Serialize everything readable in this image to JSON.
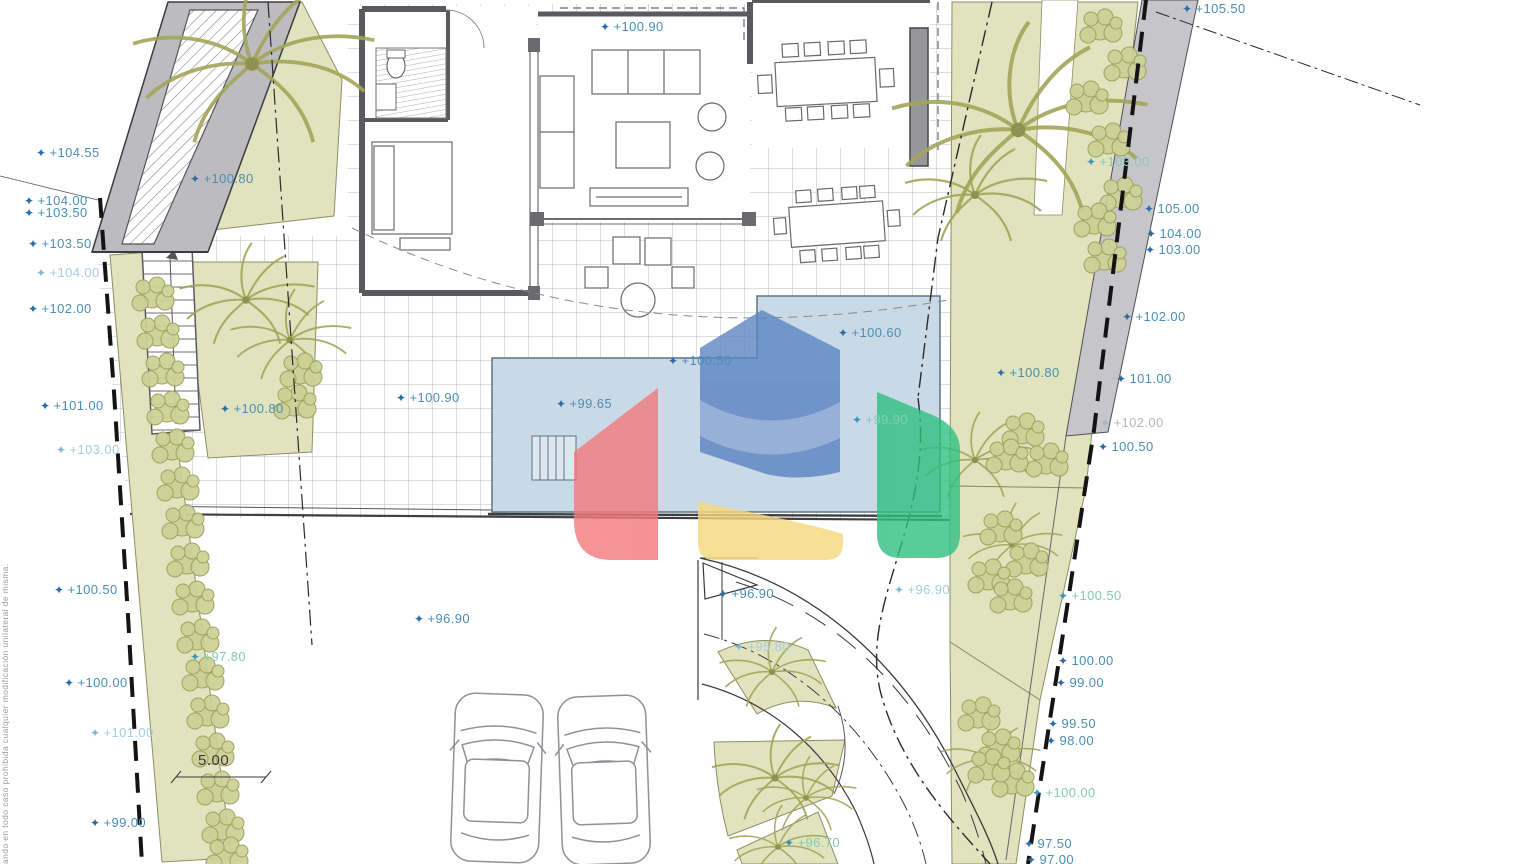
{
  "title": "Villa site plan with pool, garden and driveway",
  "dimension": {
    "value": "5.00"
  },
  "side_note": "ando en todo caso prohibida cualquier modificación unilateral de misma.",
  "colors": {
    "label_teal": "#4a8fb5",
    "label_faint": "#a5cde0",
    "label_green": "#85ccb2",
    "label_gray": "#b8b8ba",
    "marker_blue": "#2d6da6",
    "garden_green": "#e0e3bd",
    "plant_olive": "#a3a558",
    "pool_blue": "#c9d9e6",
    "wall_gray": "#bcbcc0",
    "logo_red": "#f2797d",
    "logo_blue": "#5b84c2",
    "logo_lightblue": "#8fabd6",
    "logo_yellow": "#f6d97c",
    "logo_green": "#2fbf81"
  },
  "labels": [
    {
      "t": "+104.55",
      "x": 36,
      "y": 146,
      "c": "lt"
    },
    {
      "t": "+104.00",
      "x": 24,
      "y": 194,
      "c": "lt"
    },
    {
      "t": "+103.50",
      "x": 24,
      "y": 206,
      "c": "lt"
    },
    {
      "t": "+103.50",
      "x": 28,
      "y": 237,
      "c": "lt"
    },
    {
      "t": "+104.00",
      "x": 36,
      "y": 266,
      "c": "lf"
    },
    {
      "t": "+102.00",
      "x": 28,
      "y": 302,
      "c": "lt"
    },
    {
      "t": "+101.00",
      "x": 40,
      "y": 399,
      "c": "lt"
    },
    {
      "t": "+103.00",
      "x": 56,
      "y": 443,
      "c": "lf"
    },
    {
      "t": "+100.50",
      "x": 54,
      "y": 583,
      "c": "lt"
    },
    {
      "t": "+97.80",
      "x": 190,
      "y": 650,
      "c": "lg"
    },
    {
      "t": "+100.00",
      "x": 64,
      "y": 676,
      "c": "lt"
    },
    {
      "t": "+101.00",
      "x": 90,
      "y": 726,
      "c": "lf"
    },
    {
      "t": "+99.00",
      "x": 90,
      "y": 816,
      "c": "lt"
    },
    {
      "t": "+100.90",
      "x": 600,
      "y": 20,
      "c": "lt"
    },
    {
      "t": "+100.80",
      "x": 190,
      "y": 172,
      "c": "lt"
    },
    {
      "t": "+100.80",
      "x": 220,
      "y": 402,
      "c": "lt"
    },
    {
      "t": "+100.90",
      "x": 396,
      "y": 391,
      "c": "lt"
    },
    {
      "t": "+99.65",
      "x": 556,
      "y": 397,
      "c": "lt"
    },
    {
      "t": "+100.50",
      "x": 668,
      "y": 354,
      "c": "lt"
    },
    {
      "t": "+100.60",
      "x": 838,
      "y": 326,
      "c": "lt"
    },
    {
      "t": "+99.90",
      "x": 852,
      "y": 413,
      "c": "lg"
    },
    {
      "t": "+96.90",
      "x": 414,
      "y": 612,
      "c": "lt"
    },
    {
      "t": "+96.90",
      "x": 718,
      "y": 587,
      "c": "lt"
    },
    {
      "t": "+96.90",
      "x": 894,
      "y": 583,
      "c": "lf"
    },
    {
      "t": "+95.80",
      "x": 734,
      "y": 640,
      "c": "lf"
    },
    {
      "t": "+96.70",
      "x": 784,
      "y": 836,
      "c": "lg"
    },
    {
      "t": "+105.50",
      "x": 1182,
      "y": 2,
      "c": "lt"
    },
    {
      "t": "+103.00",
      "x": 1086,
      "y": 155,
      "c": "lg"
    },
    {
      "t": "105.00",
      "x": 1144,
      "y": 202,
      "c": "lt"
    },
    {
      "t": "104.00",
      "x": 1146,
      "y": 227,
      "c": "lt"
    },
    {
      "t": "103.00",
      "x": 1145,
      "y": 243,
      "c": "lt"
    },
    {
      "t": "+102.00",
      "x": 1122,
      "y": 310,
      "c": "lt"
    },
    {
      "t": "+100.80",
      "x": 996,
      "y": 366,
      "c": "lt"
    },
    {
      "t": "101.00",
      "x": 1116,
      "y": 372,
      "c": "lt"
    },
    {
      "t": "+102.00",
      "x": 1100,
      "y": 416,
      "c": "ly"
    },
    {
      "t": "100.50",
      "x": 1098,
      "y": 440,
      "c": "lt"
    },
    {
      "t": "+100.50",
      "x": 1058,
      "y": 589,
      "c": "lg"
    },
    {
      "t": "100.00",
      "x": 1058,
      "y": 654,
      "c": "lt"
    },
    {
      "t": "99.00",
      "x": 1056,
      "y": 676,
      "c": "lt"
    },
    {
      "t": "99.50",
      "x": 1048,
      "y": 717,
      "c": "lt"
    },
    {
      "t": "98.00",
      "x": 1046,
      "y": 734,
      "c": "lt"
    },
    {
      "t": "+100.00",
      "x": 1032,
      "y": 786,
      "c": "lg"
    },
    {
      "t": "97.50",
      "x": 1024,
      "y": 837,
      "c": "lt"
    },
    {
      "t": "97.00",
      "x": 1026,
      "y": 853,
      "c": "lt"
    }
  ]
}
